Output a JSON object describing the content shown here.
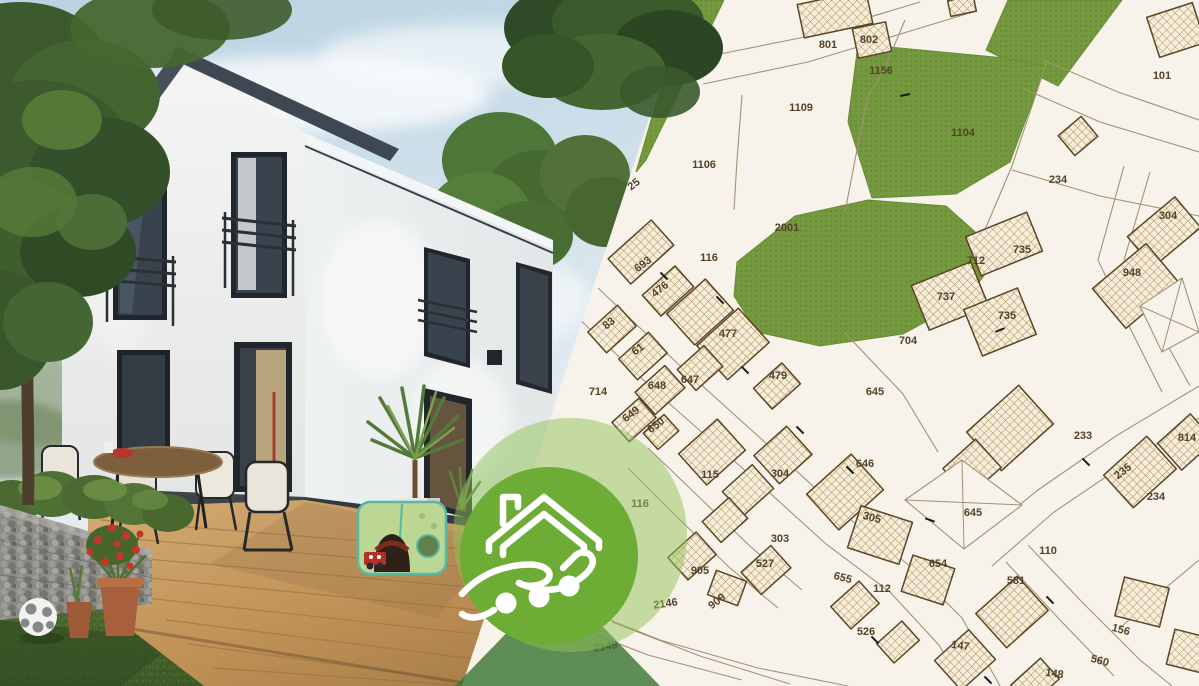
{
  "badge": {
    "icon": "house-in-hand-icon",
    "circle_color": "#6dac35",
    "halo_color": "#8fc257",
    "icon_color": "#ffffff"
  },
  "photo": {
    "subject": "single-family-house-with-terrace",
    "sky_color": "#c3d7e4",
    "lawn_color": "#48662e",
    "roof_color": "#3e4853",
    "wall_color": "#f2f3f1",
    "deck_color": "#c9a06a"
  },
  "map": {
    "background": "#f8f3ea",
    "line_color": "#a2917a",
    "building_outline": "#5c4526",
    "building_fill": "#f5eedb",
    "hatch_color": "#b08d58",
    "label_color": "#54422a",
    "green_color": "#74993e",
    "green_edge": "#6a8c38",
    "boundary": [
      [
        688,
        0
      ],
      [
        1199,
        0
      ],
      [
        1199,
        686
      ],
      [
        462,
        686
      ]
    ],
    "greens": [
      [
        [
          686,
          0
        ],
        [
          724,
          0
        ],
        [
          646,
          160
        ],
        [
          636,
          172
        ]
      ],
      [
        [
          1008,
          0
        ],
        [
          1122,
          0
        ],
        [
          1058,
          86
        ],
        [
          986,
          50
        ]
      ],
      [
        [
          858,
          44
        ],
        [
          1005,
          58
        ],
        [
          1046,
          66
        ],
        [
          1010,
          162
        ],
        [
          956,
          194
        ],
        [
          872,
          198
        ],
        [
          848,
          122
        ]
      ],
      [
        [
          737,
          262
        ],
        [
          795,
          216
        ],
        [
          868,
          200
        ],
        [
          946,
          206
        ],
        [
          1000,
          254
        ],
        [
          966,
          300
        ],
        [
          903,
          334
        ],
        [
          820,
          346
        ],
        [
          757,
          332
        ],
        [
          734,
          296
        ]
      ]
    ],
    "roads": [
      [
        [
          598,
          288
        ],
        [
          676,
          362
        ],
        [
          758,
          436
        ],
        [
          846,
          516
        ],
        [
          910,
          566
        ],
        [
          962,
          618
        ],
        [
          1000,
          686
        ]
      ],
      [
        [
          574,
          314
        ],
        [
          654,
          390
        ],
        [
          740,
          466
        ],
        [
          826,
          544
        ],
        [
          890,
          592
        ],
        [
          938,
          644
        ],
        [
          966,
          686
        ]
      ],
      [
        [
          1199,
          386
        ],
        [
          1116,
          436
        ],
        [
          1038,
          490
        ],
        [
          976,
          540
        ]
      ],
      [
        [
          1199,
          418
        ],
        [
          1128,
          462
        ],
        [
          1054,
          512
        ],
        [
          992,
          566
        ]
      ],
      [
        [
          1124,
          166
        ],
        [
          1098,
          260
        ],
        [
          1130,
          328
        ],
        [
          1162,
          392
        ]
      ],
      [
        [
          1150,
          172
        ],
        [
          1124,
          260
        ],
        [
          1156,
          324
        ],
        [
          1190,
          386
        ]
      ],
      [
        [
          700,
          58
        ],
        [
          800,
          38
        ],
        [
          920,
          2
        ]
      ],
      [
        [
          703,
          84
        ],
        [
          808,
          62
        ],
        [
          973,
          12
        ]
      ],
      [
        [
          1043,
          60
        ],
        [
          1118,
          92
        ],
        [
          1199,
          120
        ]
      ],
      [
        [
          1022,
          88
        ],
        [
          1100,
          122
        ],
        [
          1199,
          152
        ]
      ]
    ],
    "lines": [
      [
        [
          742,
          95
        ],
        [
          737,
          160
        ],
        [
          734,
          210
        ]
      ],
      [
        [
          868,
          96
        ],
        [
          856,
          155
        ],
        [
          845,
          212
        ]
      ],
      [
        [
          1012,
          170
        ],
        [
          1100,
          196
        ],
        [
          1199,
          216
        ]
      ],
      [
        [
          1046,
          64
        ],
        [
          1012,
          166
        ],
        [
          984,
          232
        ]
      ],
      [
        [
          845,
          333
        ],
        [
          903,
          394
        ],
        [
          938,
          452
        ]
      ],
      [
        [
          905,
          20
        ],
        [
          884,
          70
        ],
        [
          868,
          96
        ]
      ],
      [
        [
          648,
          448
        ],
        [
          700,
          498
        ],
        [
          752,
          548
        ],
        [
          802,
          590
        ]
      ],
      [
        [
          628,
          468
        ],
        [
          678,
          518
        ],
        [
          730,
          568
        ],
        [
          778,
          608
        ]
      ],
      [
        [
          560,
          600
        ],
        [
          660,
          640
        ],
        [
          758,
          668
        ],
        [
          848,
          686
        ]
      ],
      [
        [
          552,
          618
        ],
        [
          648,
          655
        ],
        [
          742,
          680
        ]
      ],
      [
        [
          612,
          622
        ],
        [
          700,
          656
        ],
        [
          790,
          684
        ]
      ],
      [
        [
          1028,
          545
        ],
        [
          1082,
          602
        ],
        [
          1140,
          660
        ],
        [
          1172,
          686
        ]
      ],
      [
        [
          1006,
          562
        ],
        [
          1060,
          620
        ],
        [
          1114,
          676
        ]
      ],
      [
        [
          1199,
          560
        ],
        [
          1156,
          596
        ],
        [
          1120,
          628
        ]
      ]
    ],
    "buildings": [
      [
        835,
        14,
        70,
        34,
        -12
      ],
      [
        872,
        40,
        34,
        30,
        -12
      ],
      [
        962,
        6,
        26,
        16,
        -12
      ],
      [
        1176,
        30,
        48,
        42,
        -18
      ],
      [
        1078,
        136,
        30,
        26,
        -40
      ],
      [
        1164,
        232,
        62,
        40,
        -40
      ],
      [
        1136,
        286,
        70,
        52,
        -40
      ],
      [
        1004,
        244,
        66,
        42,
        -22
      ],
      [
        950,
        296,
        64,
        48,
        -22
      ],
      [
        1000,
        322,
        58,
        50,
        -22
      ],
      [
        641,
        252,
        58,
        34,
        -42
      ],
      [
        668,
        291,
        44,
        28,
        -42
      ],
      [
        612,
        329,
        40,
        28,
        -42
      ],
      [
        643,
        356,
        40,
        28,
        -42
      ],
      [
        700,
        312,
        52,
        42,
        -42
      ],
      [
        733,
        344,
        56,
        46,
        -42
      ],
      [
        777,
        386,
        38,
        28,
        -42
      ],
      [
        660,
        390,
        40,
        30,
        -42
      ],
      [
        700,
        368,
        36,
        28,
        -42
      ],
      [
        634,
        420,
        36,
        26,
        -42
      ],
      [
        661,
        432,
        28,
        22,
        -42
      ],
      [
        712,
        452,
        52,
        42,
        -42
      ],
      [
        748,
        490,
        40,
        32,
        -42
      ],
      [
        783,
        455,
        44,
        38,
        -42
      ],
      [
        725,
        520,
        36,
        28,
        -42
      ],
      [
        766,
        570,
        40,
        30,
        -42
      ],
      [
        845,
        492,
        60,
        48,
        -42
      ],
      [
        880,
        535,
        54,
        44,
        18
      ],
      [
        928,
        580,
        44,
        38,
        18
      ],
      [
        855,
        605,
        38,
        30,
        -42
      ],
      [
        1010,
        428,
        70,
        52,
        -42
      ],
      [
        972,
        468,
        44,
        38,
        -42
      ],
      [
        1140,
        472,
        58,
        44,
        -42
      ],
      [
        1186,
        442,
        44,
        36,
        -42
      ],
      [
        1012,
        612,
        56,
        46,
        -42
      ],
      [
        965,
        660,
        46,
        40,
        -42
      ],
      [
        1035,
        682,
        40,
        28,
        -42
      ],
      [
        1142,
        602,
        46,
        40,
        14
      ],
      [
        1192,
        652,
        44,
        36,
        14
      ],
      [
        898,
        642,
        34,
        26,
        -42
      ],
      [
        692,
        556,
        38,
        30,
        -42
      ],
      [
        727,
        588,
        32,
        26,
        20
      ]
    ],
    "outline_buildings": [
      [
        [
          905,
          500
        ],
        [
          962,
          460
        ],
        [
          1022,
          505
        ],
        [
          964,
          549
        ]
      ],
      [
        [
          1140,
          306
        ],
        [
          1182,
          278
        ],
        [
          1199,
          332
        ],
        [
          1162,
          352
        ]
      ]
    ],
    "ticks": [
      [
        664,
        276,
        45
      ],
      [
        720,
        300,
        45
      ],
      [
        745,
        370,
        45
      ],
      [
        800,
        430,
        45
      ],
      [
        850,
        470,
        45
      ],
      [
        930,
        520,
        20
      ],
      [
        1050,
        600,
        45
      ],
      [
        875,
        640,
        45
      ],
      [
        905,
        95,
        -12
      ],
      [
        1000,
        330,
        -22
      ],
      [
        1086,
        462,
        45
      ],
      [
        988,
        680,
        45
      ]
    ],
    "labels": [
      {
        "t": "801",
        "x": 828,
        "y": 48
      },
      {
        "t": "802",
        "x": 869,
        "y": 43
      },
      {
        "t": "1156",
        "x": 881,
        "y": 74
      },
      {
        "t": "101",
        "x": 1162,
        "y": 79
      },
      {
        "t": "1109",
        "x": 801,
        "y": 111
      },
      {
        "t": "1104",
        "x": 963,
        "y": 136
      },
      {
        "t": "1106",
        "x": 704,
        "y": 168
      },
      {
        "t": "25",
        "x": 636,
        "y": 187,
        "r": -38
      },
      {
        "t": "234",
        "x": 1058,
        "y": 183
      },
      {
        "t": "304",
        "x": 1168,
        "y": 219
      },
      {
        "t": "2001",
        "x": 787,
        "y": 231
      },
      {
        "t": "735",
        "x": 1022,
        "y": 253
      },
      {
        "t": "693",
        "x": 645,
        "y": 267,
        "r": -38
      },
      {
        "t": "116",
        "x": 709,
        "y": 261
      },
      {
        "t": "712",
        "x": 976,
        "y": 264
      },
      {
        "t": "948",
        "x": 1132,
        "y": 276
      },
      {
        "t": "476",
        "x": 662,
        "y": 292,
        "r": -38
      },
      {
        "t": "737",
        "x": 946,
        "y": 300
      },
      {
        "t": "735",
        "x": 1007,
        "y": 319
      },
      {
        "t": "83",
        "x": 611,
        "y": 326,
        "r": -38
      },
      {
        "t": "61",
        "x": 640,
        "y": 352,
        "r": -38
      },
      {
        "t": "477",
        "x": 728,
        "y": 337
      },
      {
        "t": "704",
        "x": 908,
        "y": 344
      },
      {
        "t": "479",
        "x": 778,
        "y": 379
      },
      {
        "t": "647",
        "x": 690,
        "y": 383
      },
      {
        "t": "648",
        "x": 657,
        "y": 389
      },
      {
        "t": "714",
        "x": 598,
        "y": 395
      },
      {
        "t": "645",
        "x": 875,
        "y": 395
      },
      {
        "t": "649",
        "x": 633,
        "y": 417,
        "r": -38
      },
      {
        "t": "650",
        "x": 658,
        "y": 428,
        "r": -38
      },
      {
        "t": "233",
        "x": 1083,
        "y": 439
      },
      {
        "t": "814",
        "x": 1187,
        "y": 441
      },
      {
        "t": "646",
        "x": 865,
        "y": 467
      },
      {
        "t": "235",
        "x": 1125,
        "y": 474,
        "r": -38
      },
      {
        "t": "115",
        "x": 710,
        "y": 478
      },
      {
        "t": "304",
        "x": 780,
        "y": 477
      },
      {
        "t": "234",
        "x": 1156,
        "y": 500
      },
      {
        "t": "116",
        "x": 640,
        "y": 507
      },
      {
        "t": "305",
        "x": 871,
        "y": 521,
        "r": 15
      },
      {
        "t": "645",
        "x": 973,
        "y": 516
      },
      {
        "t": "303",
        "x": 780,
        "y": 542
      },
      {
        "t": "110",
        "x": 1048,
        "y": 554
      },
      {
        "t": "527",
        "x": 765,
        "y": 567
      },
      {
        "t": "654",
        "x": 938,
        "y": 567
      },
      {
        "t": "905",
        "x": 700,
        "y": 574
      },
      {
        "t": "655",
        "x": 842,
        "y": 581,
        "r": 15
      },
      {
        "t": "581",
        "x": 1016,
        "y": 584
      },
      {
        "t": "112",
        "x": 882,
        "y": 592
      },
      {
        "t": "2146",
        "x": 666,
        "y": 607,
        "r": -8
      },
      {
        "t": "909",
        "x": 719,
        "y": 604,
        "r": -38
      },
      {
        "t": "156",
        "x": 1120,
        "y": 633,
        "r": 15
      },
      {
        "t": "526",
        "x": 866,
        "y": 635
      },
      {
        "t": "147",
        "x": 960,
        "y": 649,
        "r": 8
      },
      {
        "t": "2149",
        "x": 606,
        "y": 650,
        "r": -8
      },
      {
        "t": "560",
        "x": 1099,
        "y": 664,
        "r": 15
      },
      {
        "t": "148",
        "x": 1054,
        "y": 677,
        "r": 8
      }
    ]
  }
}
